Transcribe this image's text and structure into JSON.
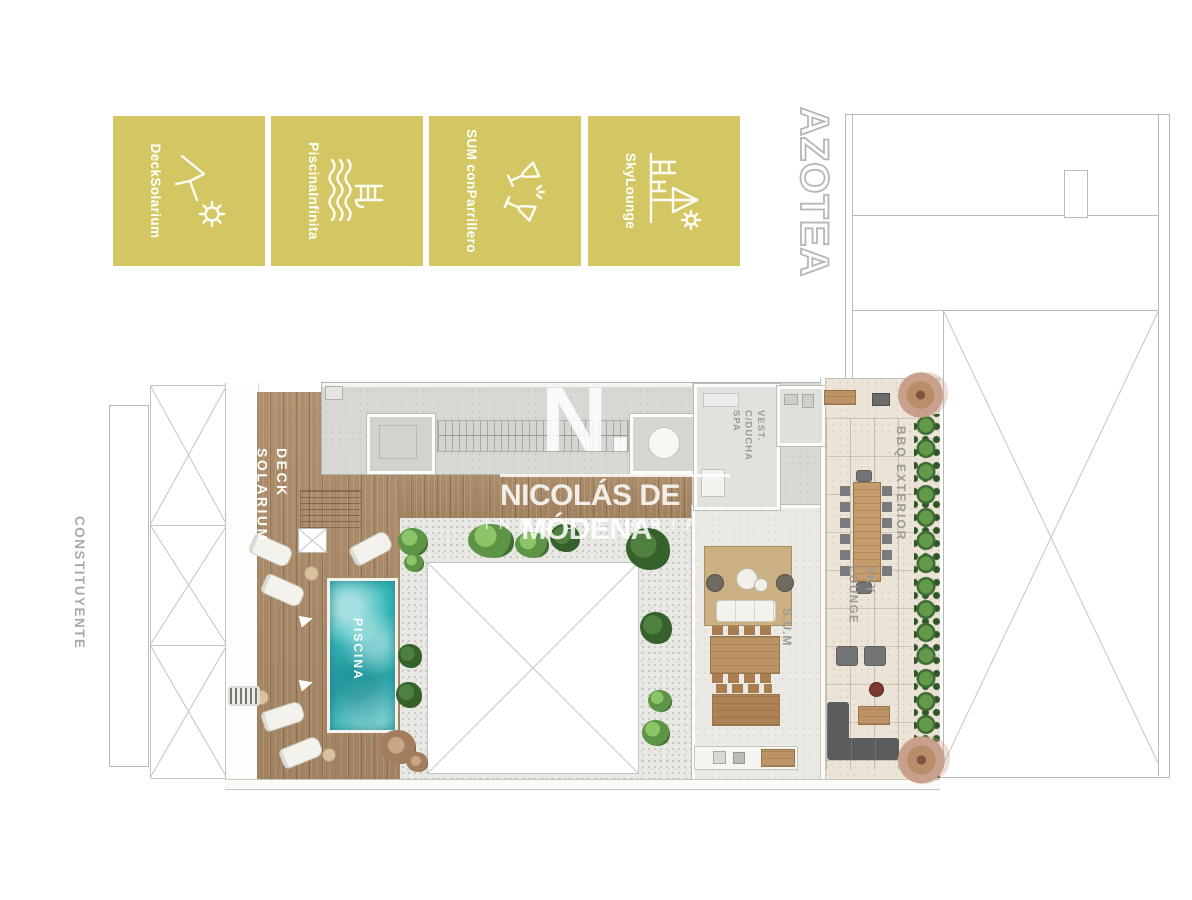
{
  "colors": {
    "badge-gold": "#d4c662",
    "pool-water": "#38b9ba",
    "deck-wood": "#ab8a66",
    "hedge-green": "#4e8040",
    "label-gray": "#9b9b93",
    "outline-gray": "#b7babc",
    "watermark-white": "rgba(255,255,255,0.85)"
  },
  "legend": {
    "badges": [
      {
        "icon": "sun-lounger-icon",
        "lines": [
          "Deck",
          "Solarium"
        ]
      },
      {
        "icon": "infinity-pool-icon",
        "lines": [
          "Piscina",
          "Infinita"
        ]
      },
      {
        "icon": "cheers-glasses-icon",
        "lines": [
          "SUM con",
          "Parrillero"
        ]
      },
      {
        "icon": "parasol-deck-icon",
        "lines": [
          "Sky",
          "Lounge"
        ]
      }
    ]
  },
  "floor_title": "AZOTEA",
  "street_label": "CONSTITUYENTE",
  "plan_labels": {
    "deck": [
      "DECK",
      "SOLARIUM"
    ],
    "pool": "PISCINA",
    "vest": [
      "VEST.",
      "C/DUCHA",
      "SPA"
    ],
    "sum": "S.U.M",
    "sky": [
      "SKY",
      "LOUNGE"
    ],
    "bbq": "BBQ EXTERIOR"
  },
  "watermark": {
    "monogram": "N.",
    "brand": "NICOLÁS DE MÓDENA",
    "registered": "®",
    "tagline": "INMOBILIARIA"
  }
}
